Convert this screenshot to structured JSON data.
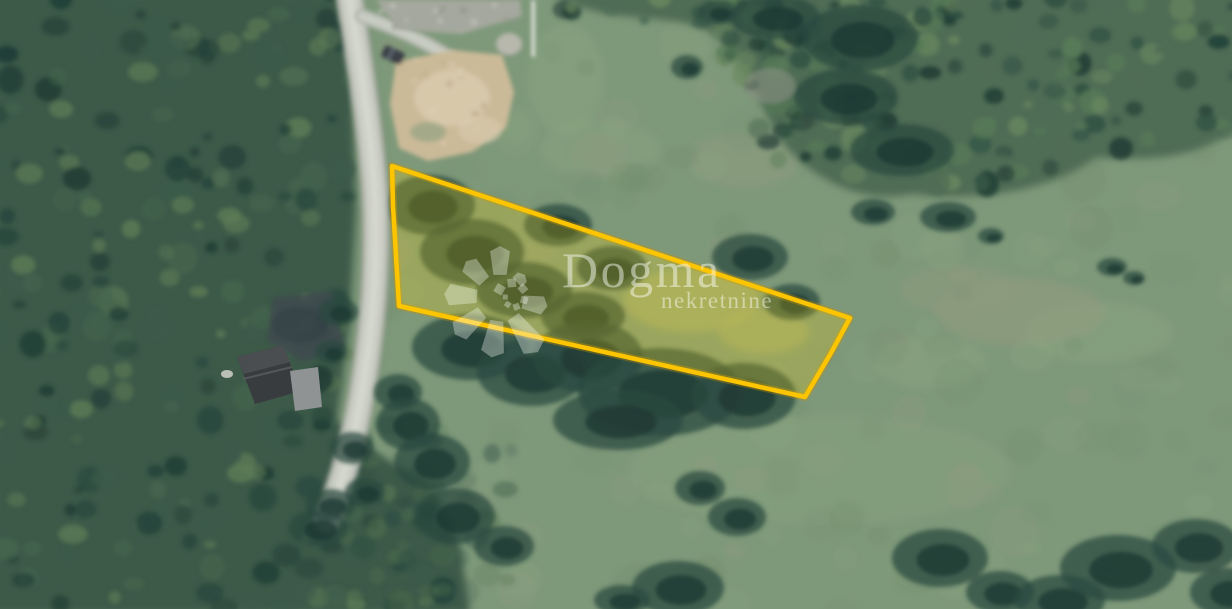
{
  "watermark": {
    "brand": "Dogma",
    "tagline": "nekretnine",
    "logo": "dogma-pinwheel-flower-logo",
    "text_color": "rgba(250,252,246,0.48)",
    "logo_color": "rgba(250,252,246,0.34)"
  },
  "parcel_overlay": {
    "points": "392,166 850,318 831,353 805,397 399,306 393,206",
    "stroke_color": "#FDC500",
    "halo_color": "#C79000",
    "stroke_width": "4.5",
    "fill_color": "#FFD400",
    "fill_opacity": "0.22"
  },
  "scene": {
    "features": [
      {
        "name": "forest-left",
        "type": "dense-trees"
      },
      {
        "name": "forest-top-right",
        "type": "dense-trees"
      },
      {
        "name": "meadow",
        "type": "grassland"
      },
      {
        "name": "access-road",
        "type": "gravel-road"
      },
      {
        "name": "bare-soil-patch",
        "type": "dirt"
      },
      {
        "name": "gravel-apron",
        "type": "paved-area"
      },
      {
        "name": "house-dark-roof",
        "type": "building"
      },
      {
        "name": "utility-pole",
        "type": "pole"
      },
      {
        "name": "rock",
        "type": "boulder"
      },
      {
        "name": "parked-vehicle",
        "type": "car"
      },
      {
        "name": "shrub-clusters",
        "type": "bushes"
      },
      {
        "name": "highlighted-parcel",
        "type": "land-parcel-outline"
      }
    ],
    "palette": {
      "meadow_base": "#7E997A",
      "meadow_light": "#8CA681",
      "meadow_tan": "#959C80",
      "forest_dark": "#24423A",
      "forest_mid": "#3C5A4A",
      "forest_light": "#5C7B55",
      "forest_deep": "#1D3A33",
      "tr_base": "#4F6C55",
      "tr_dark": "#2F5042",
      "tr_light": "#6B8A60",
      "road_light": "#CBCEC4",
      "road_mid": "#AFB3A9",
      "gravel": "#A5A89E",
      "dirt": "#CBBA98",
      "dirt_light": "#DACCAF",
      "roof_dark": "#383C3F",
      "roof_light": "#8F9394",
      "asphalt": "#414C50",
      "pole": "#E9EAE5",
      "rock": "#B8B8AD",
      "shrub": "#2A4840",
      "shrub_deep": "#1E3833"
    }
  }
}
